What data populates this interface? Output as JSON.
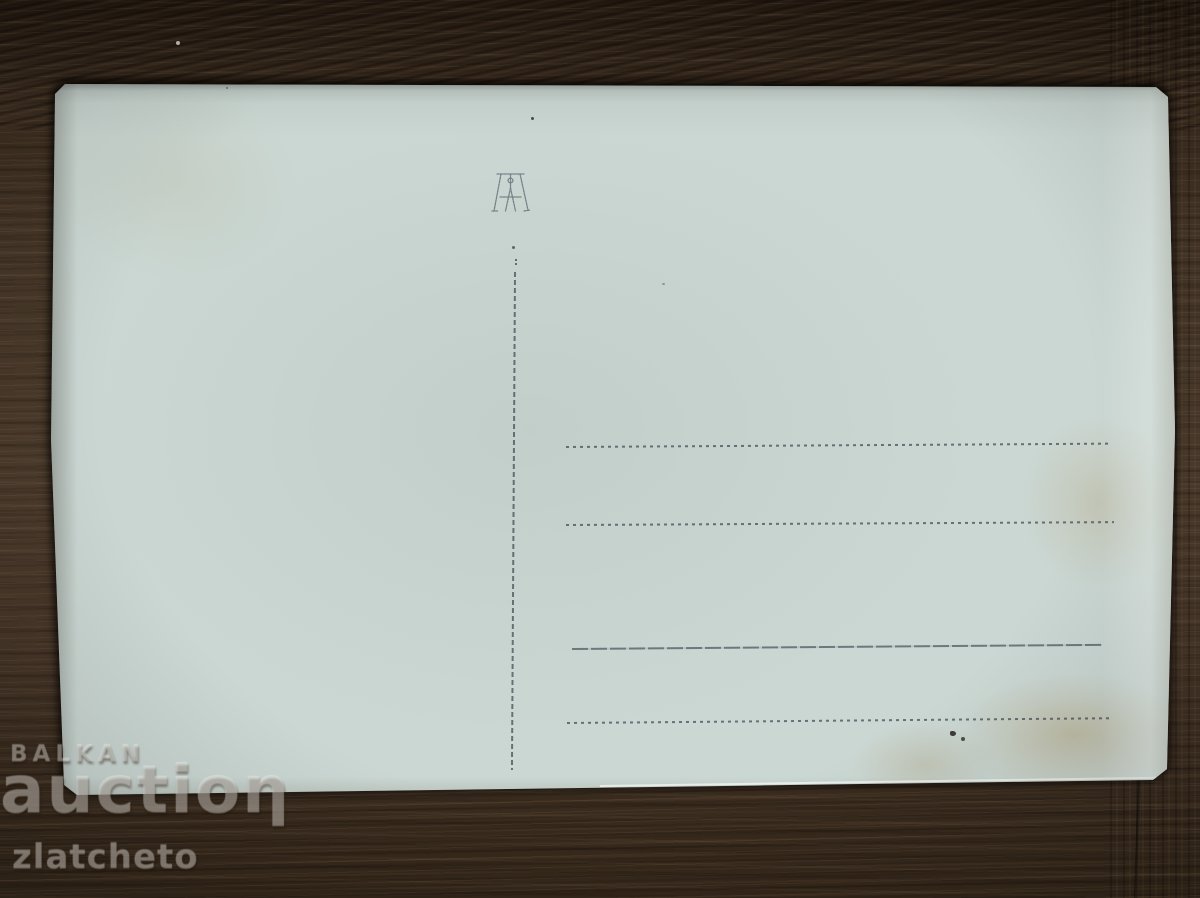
{
  "scene": {
    "type": "photograph",
    "subject": "blank back side of an old postcard lying on a dark wooden table"
  },
  "postcard": {
    "monogram_icon": "publisher-monogram-stamp",
    "divider_line": "vertical dotted divider",
    "address_lines": [
      "dotted",
      "dotted",
      "solid",
      "dotted"
    ],
    "marks": [
      "ink specks bottom right",
      "yellow-brown stains",
      "small dot top center"
    ]
  },
  "watermark": {
    "line1": "BALKAN",
    "line2": "auctioƞ",
    "line3": "zlatcheto"
  },
  "colors": {
    "wood_base": "#4b3b2c",
    "wood_dark_top": "#211810",
    "card_paper": "#cbd7d3",
    "card_highlight": "#eef4ef",
    "line_ink": "#32424e",
    "stain": "#a48240"
  }
}
